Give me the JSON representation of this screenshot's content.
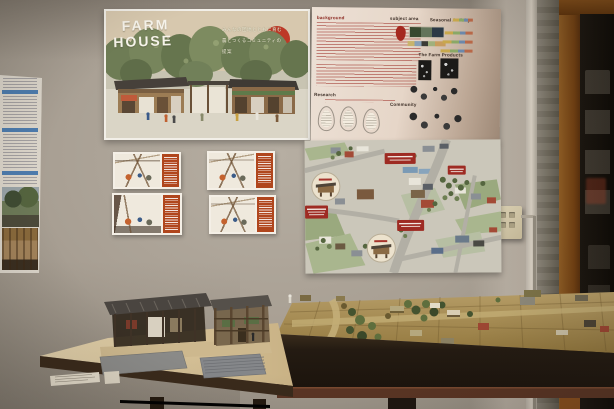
{
  "scene": {
    "description": "Exhibition display of the FARM HOUSE architecture project: wall posters above two tables holding wooden scale models"
  },
  "title_poster": {
    "title_line1": "FARM",
    "title_line2": "HOUSE",
    "subtitle_line1": "みんなの団地とともに育む",
    "subtitle_line2": "農とつくるコミュニティの",
    "subtitle_line3": "提案"
  },
  "info_poster": {
    "heading_background": "background",
    "heading_subject_area": "subject area",
    "heading_seasonal": "Seasonal Activity",
    "heading_products": "The Farm Products",
    "heading_research": "Research",
    "heading_community": "Community"
  },
  "colors": {
    "wall": "#a89f93",
    "sun_red": "#bd3927",
    "accent_orange": "#b0461d",
    "callout_red": "#9e2b23",
    "tree_green": "#6e7c55",
    "table_wood": "#d9c49c",
    "diorama_base": "#a98f58",
    "dark_table_side": "#241b12"
  }
}
